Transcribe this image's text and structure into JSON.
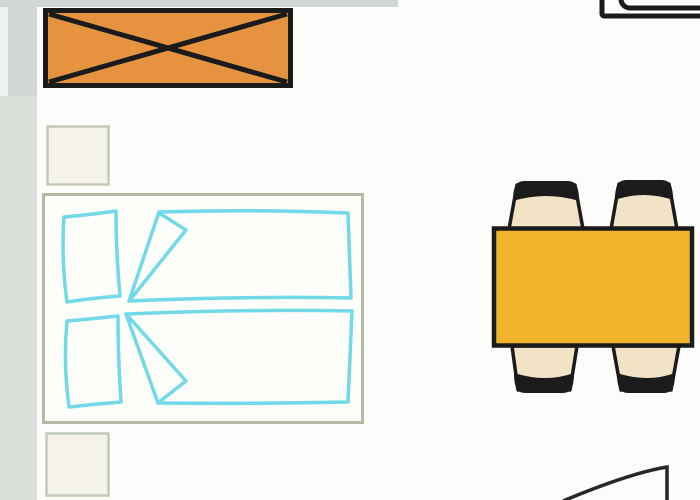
{
  "page": {
    "type": "floor-plan",
    "description": "Room floor plan with wardrobe, double bed, two nightstands, dining table with four chairs, sink unit and door swing"
  },
  "colors": {
    "background": "#fcfdfa",
    "wall_strip": "#dae0d9",
    "wall_strip_dark": "#d1d7d4",
    "wall_margin_light": "#eff2ef",
    "outline_black": "#1b1b1b",
    "wardrobe_fill": "#e6923e",
    "table_fill": "#f2b32c",
    "chair_seat_fill": "#f2e3c6",
    "bed_fill": "#fdfdfa",
    "bed_frame_stroke": "#b4bba4",
    "bed_linen_stroke": "#72d9e8",
    "nightstand_fill": "#f6f4ea",
    "nightstand_stroke": "#c2c9b4",
    "door_stroke": "#262626",
    "white": "#ffffff"
  },
  "furniture": {
    "wardrobe": {
      "name": "wardrobe",
      "symbol": "crossed-rectangle"
    },
    "bed": {
      "name": "double-bed",
      "pillows": 2,
      "duvets": 2
    },
    "nightstands": {
      "count": 2
    },
    "dining_table": {
      "name": "dining-table",
      "chairs": 4
    },
    "sink_unit": {
      "name": "sink-unit",
      "note": "partially visible at top edge"
    },
    "door": {
      "name": "door-swing"
    }
  }
}
